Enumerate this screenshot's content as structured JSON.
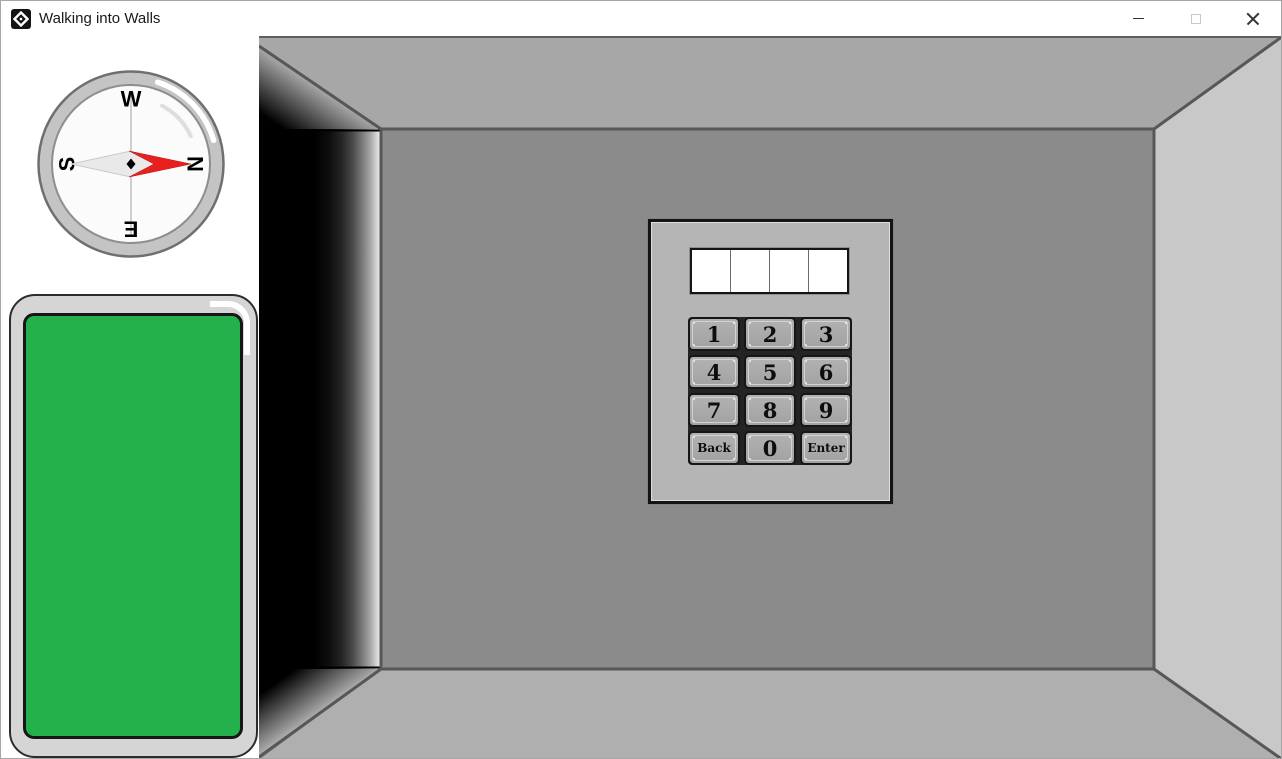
{
  "window": {
    "title": "Walking into Walls",
    "controls": [
      {
        "name": "minimize"
      },
      {
        "name": "maximize",
        "disabled": true
      },
      {
        "name": "close"
      }
    ]
  },
  "sidebar": {
    "compass": {
      "points": [
        {
          "label": "W",
          "position": "top"
        },
        {
          "label": "N",
          "position": "right"
        },
        {
          "label": "E",
          "position": "bottom"
        },
        {
          "label": "S",
          "position": "left"
        }
      ],
      "needle_color": "#e8201e"
    },
    "phone": {
      "screen_color": "#24b14c"
    }
  },
  "room": {
    "colors": {
      "back_wall": "#8b8b8b",
      "ceiling": "#a7a7a7",
      "floor": "#afafaf",
      "right_wall": "#c8c8c8",
      "left_side": "#000000"
    }
  },
  "keypad": {
    "display": {
      "cells": 4,
      "value": ""
    },
    "buttons": [
      {
        "label": "1"
      },
      {
        "label": "2"
      },
      {
        "label": "3"
      },
      {
        "label": "4"
      },
      {
        "label": "5"
      },
      {
        "label": "6"
      },
      {
        "label": "7"
      },
      {
        "label": "8"
      },
      {
        "label": "9"
      },
      {
        "label": "Back"
      },
      {
        "label": "0"
      },
      {
        "label": "Enter"
      }
    ]
  }
}
